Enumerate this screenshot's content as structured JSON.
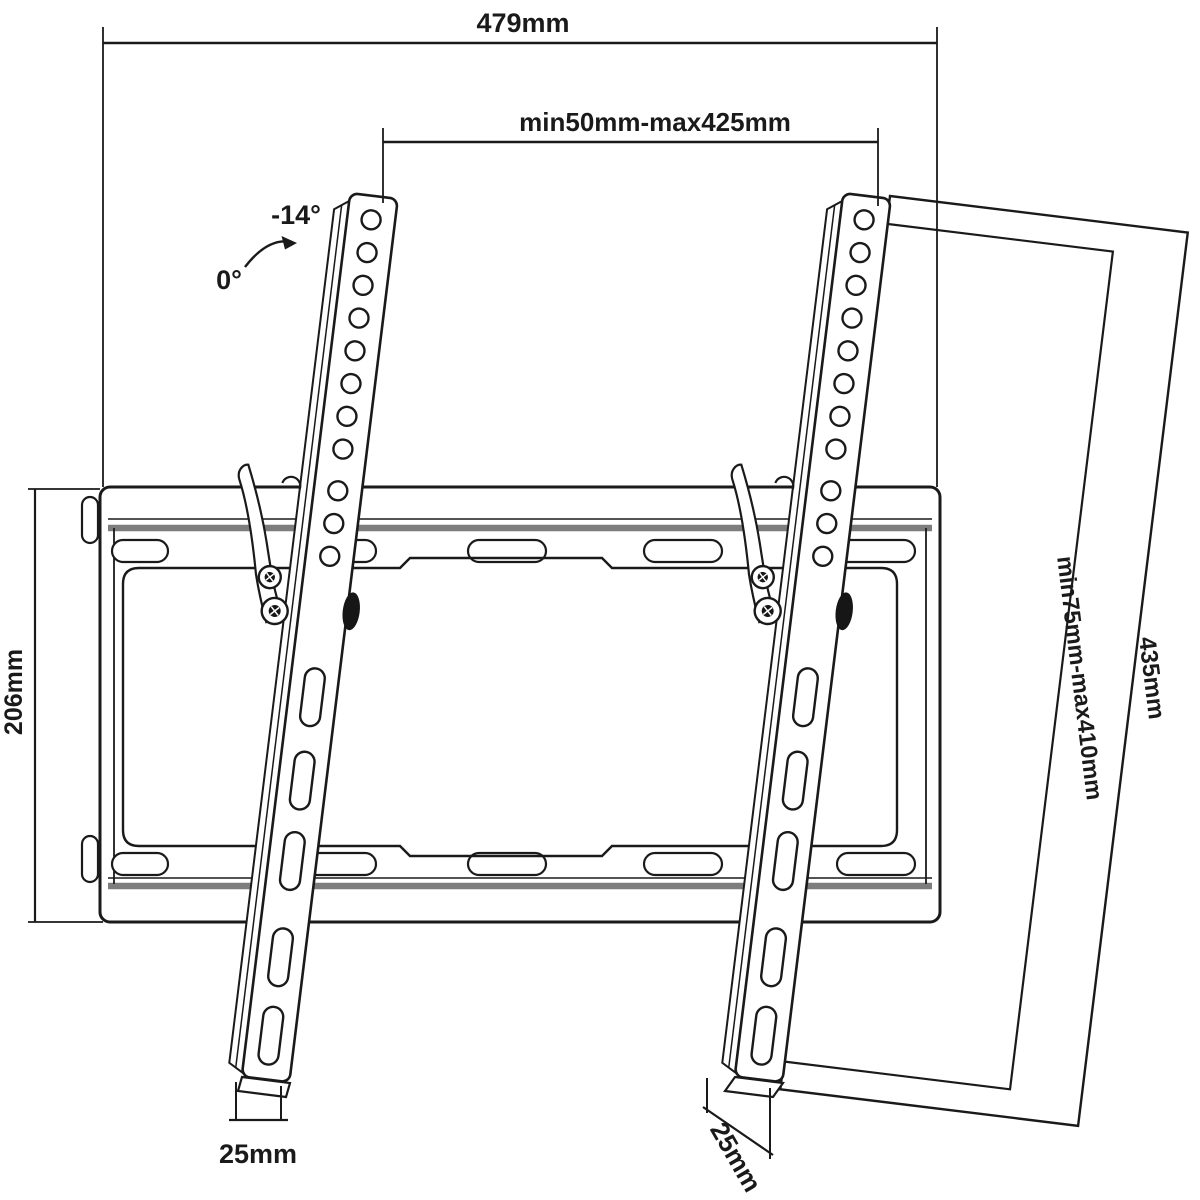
{
  "diagram": {
    "subject": "Tilting TV wall mount bracket technical drawing",
    "dimensions": {
      "total_width": "479mm",
      "vesa_width_range": "min50mm-max425mm",
      "wall_plate_height": "206mm",
      "bracket_arm_length": "435mm",
      "vesa_height_range": "min75mm-max410mm",
      "hook_depth_left": "25mm",
      "hook_depth_right": "25mm"
    },
    "tilt": {
      "max_angle": "-14°",
      "rest_angle": "0°"
    },
    "colors": {
      "line": "#1a1a1a",
      "accent_gray": "#7d7d7d",
      "background": "#ffffff"
    }
  }
}
